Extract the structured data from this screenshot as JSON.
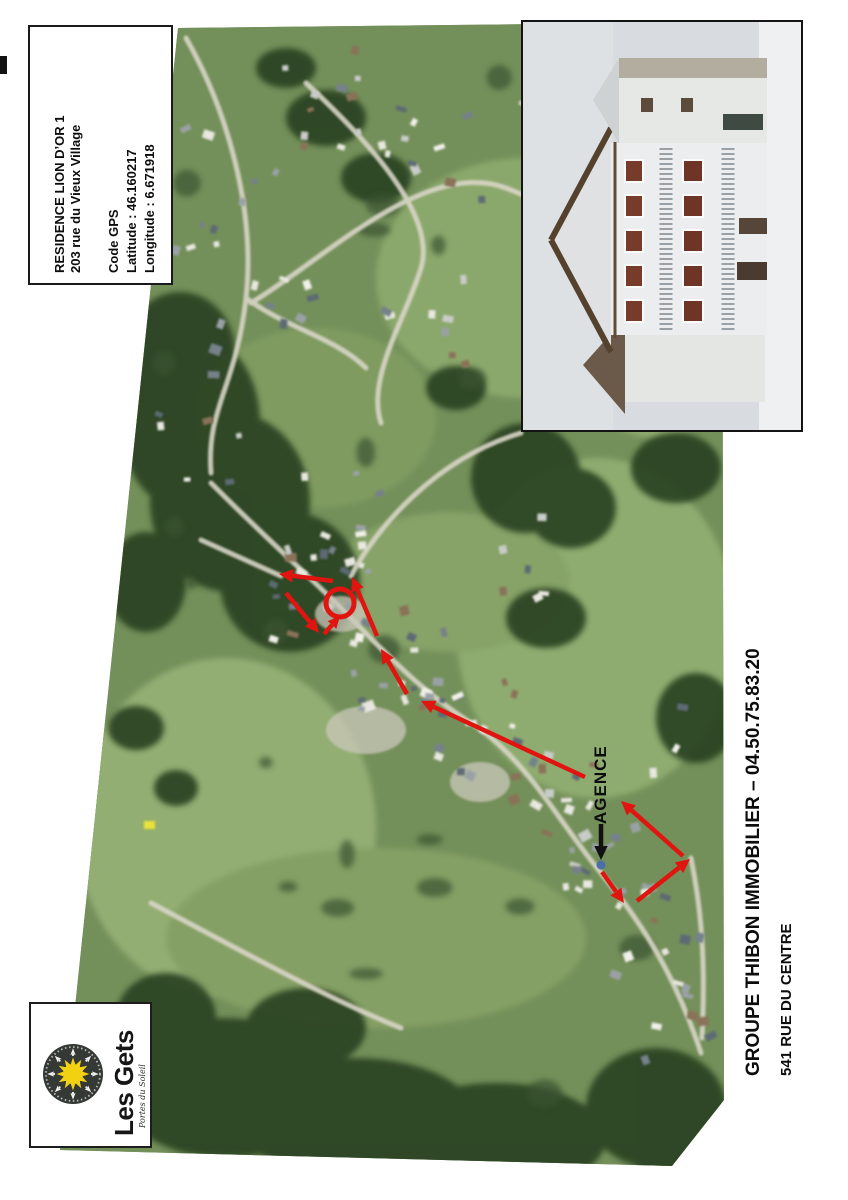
{
  "info_box": {
    "title": "RESIDENCE LION D’OR 1",
    "address": "203 rue du Vieux Village",
    "gps_heading": "Code GPS",
    "latitude": "Latitude : 46.160217",
    "longitude": "Longitude : 6.671918"
  },
  "map": {
    "agence_label": "AGENCE",
    "accent_red": "#e01510",
    "annotation_black": "#111111",
    "destination_circle": {
      "cx": 280,
      "cy": 581,
      "r": 14
    },
    "black_arrow": {
      "x1": 541,
      "y1": 802,
      "x2": 541,
      "y2": 838
    },
    "marker_dot": {
      "cx": 541,
      "cy": 843,
      "color": "#4a6ea8"
    },
    "route_arrows": [
      [
        542,
        850,
        564,
        881
      ],
      [
        577,
        879,
        630,
        837
      ],
      [
        623,
        834,
        561,
        779
      ],
      [
        525,
        755,
        361,
        679
      ],
      [
        347,
        672,
        321,
        627
      ],
      [
        317,
        614,
        292,
        555
      ],
      [
        273,
        559,
        219,
        552
      ],
      [
        226,
        571,
        259,
        611
      ],
      [
        264,
        612,
        280,
        594
      ]
    ]
  },
  "logo": {
    "name": "Les Gets",
    "tagline": "Portes du Soleil",
    "sun_color": "#f2d112"
  },
  "footer": {
    "line1": "GROUPE THIBON IMMOBILIER – 04.50.75.83.20",
    "line2": "541 RUE DU CENTRE"
  }
}
